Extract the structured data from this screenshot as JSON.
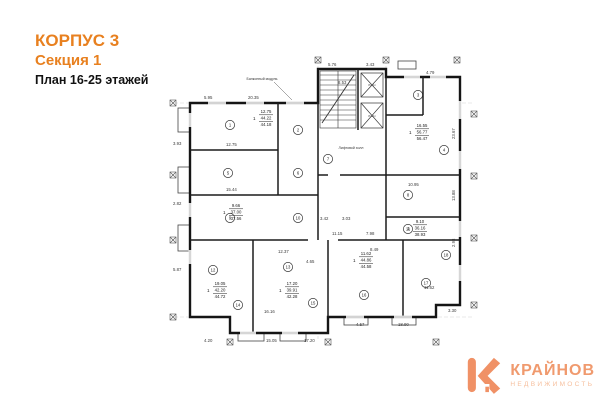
{
  "header": {
    "building": "КОРПУС 3",
    "section": "Секция 1",
    "floors": "План 16-25 этажей"
  },
  "logo": {
    "brand": "КРАЙНОВ",
    "tagline": "НЕДВИЖИМОСТЬ"
  },
  "colors": {
    "accent_orange": "#e8801f",
    "logo_orange": "#f09a6e",
    "wall_black": "#151515"
  },
  "plan": {
    "annotations": {
      "balcony_module": "Балконный модуль",
      "lift_hall": "Лифтовой холл",
      "lift": "Лифт"
    },
    "rooms": [
      "1",
      "2",
      "3",
      "4",
      "5",
      "6",
      "7",
      "8",
      "9",
      "10",
      "11",
      "12",
      "13",
      "14",
      "15",
      "16",
      "17",
      "18"
    ],
    "apartments": [
      {
        "num": "1",
        "l1": "12.75",
        "l2": "44.22",
        "l3": "44.18"
      },
      {
        "num": "1",
        "l1": "16.55",
        "l2": "56.77",
        "l3": "56.47"
      },
      {
        "num": "1",
        "l1": "9.66",
        "l2": "37.00",
        "l3": "37.56"
      },
      {
        "num": "1",
        "l1": "9.10",
        "l2": "36.16",
        "l3": "38.93"
      },
      {
        "num": "1",
        "l1": "19.05",
        "l2": "42.20",
        "l3": "44.72"
      },
      {
        "num": "1",
        "l1": "17.20",
        "l2": "39.91",
        "l3": "42.28"
      },
      {
        "num": "1",
        "l1": "11.62",
        "l2": "44.86",
        "l3": "44.58"
      }
    ],
    "dims": [
      "5.95",
      "20.35",
      "5.76",
      "3.43",
      "8.53",
      "4.79",
      "3.93",
      "2.82",
      "5.87",
      "12.75",
      "15.44",
      "23.67",
      "13.88",
      "2.98",
      "11.62",
      "4.20",
      "15.05",
      "17.20",
      "4.57",
      "18.90",
      "3.30",
      "16.16",
      "10.95",
      "3.42",
      "3.03",
      "11.15",
      "7.98",
      "8.49",
      "12.37",
      "4.65"
    ]
  }
}
